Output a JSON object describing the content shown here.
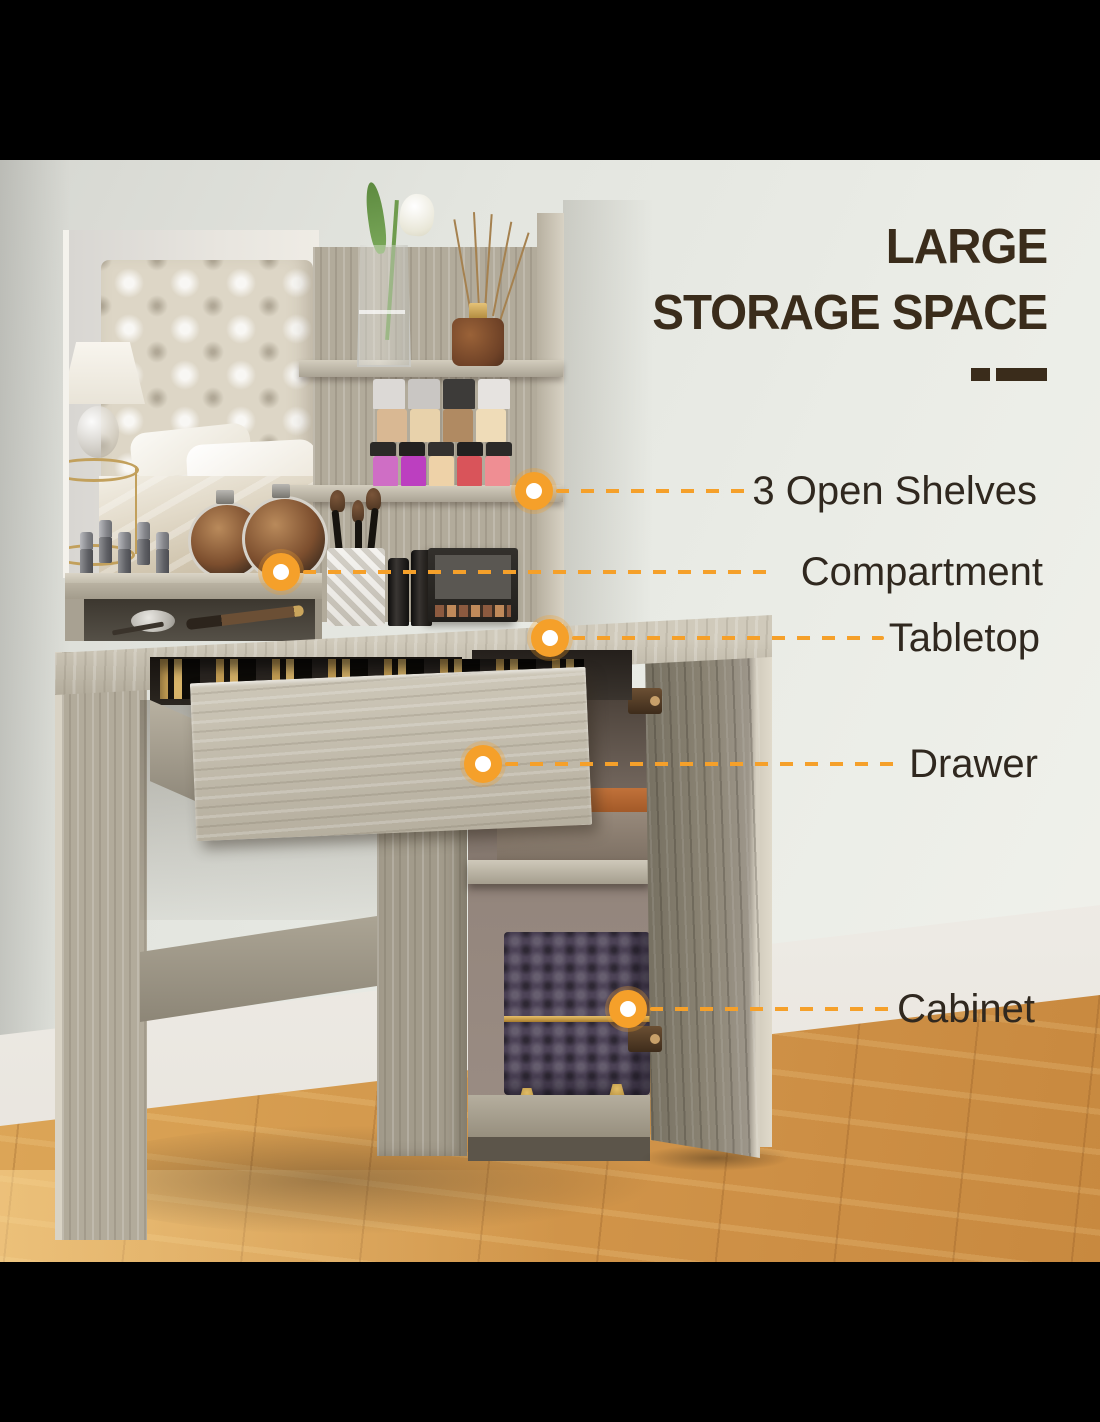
{
  "title": {
    "line1": "LARGE",
    "line2": "STORAGE SPACE"
  },
  "callouts": [
    {
      "label": "3 Open Shelves"
    },
    {
      "label": "Compartment"
    },
    {
      "label": "Tabletop"
    },
    {
      "label": "Drawer"
    },
    {
      "label": "Cabinet"
    }
  ],
  "colors": {
    "accent": "#F5A02A",
    "title_text": "#3A2C1B",
    "label_text": "#30281F",
    "wall": "#E8EAE4",
    "baseboard": "#F6F4F0",
    "floor_wood": "#D19A4F",
    "furniture_wood": "#B5AE9E",
    "cabinet_door_wood": "#8B8476"
  }
}
